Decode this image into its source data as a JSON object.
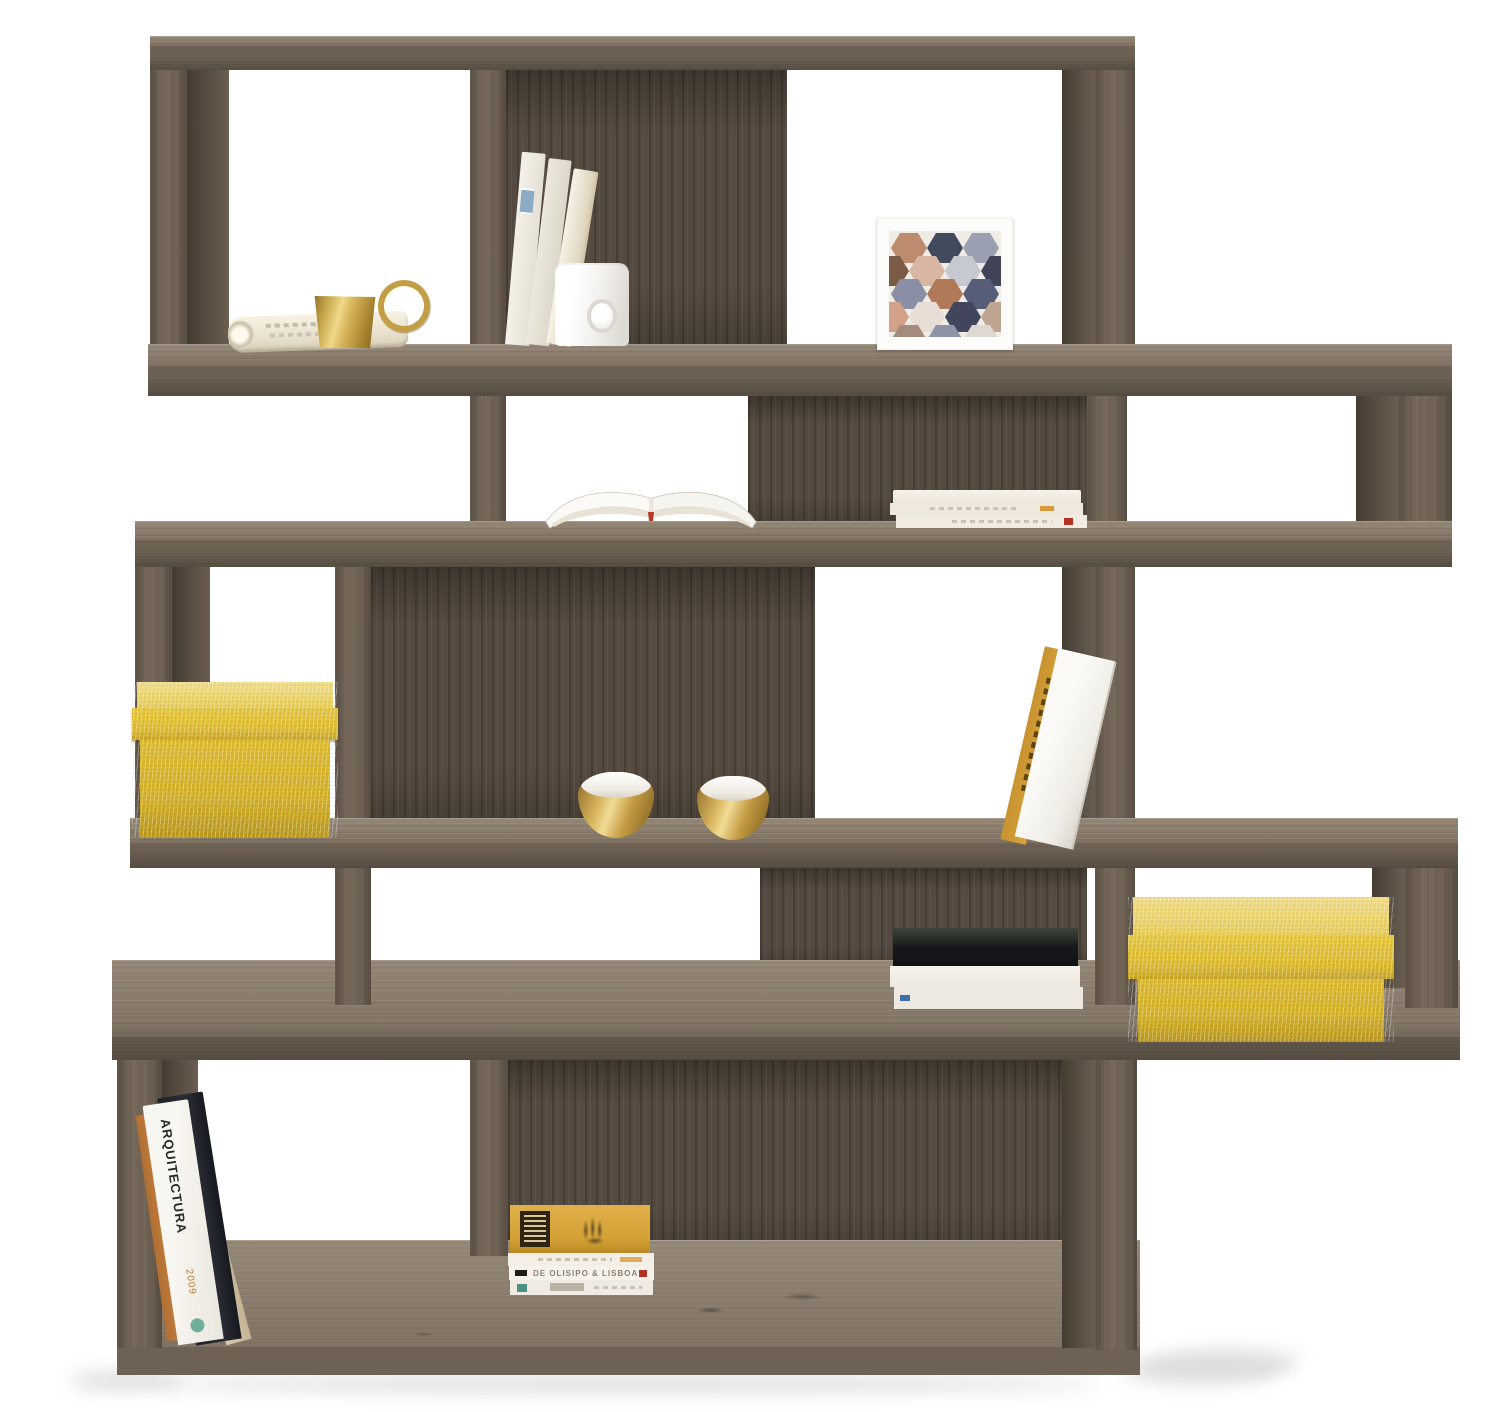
{
  "scene": {
    "type": "product-photograph",
    "subject": "Staggered zigzag wooden bookcase (5 open rows) in dark walnut finish, styled with books and decor objects on a white studio background",
    "background_color": "#ffffff"
  },
  "palette": {
    "wood_front": "#6e6254",
    "wood_top_surface": "#948776",
    "wood_back_panel": "#554a3f",
    "wood_edge_dark": "#4a4136",
    "accent_yellow_fabric": "#dcb92c",
    "brass_gold": "#c9a84c",
    "paper_cream": "#f3efe6",
    "mug_white": "#ffffff",
    "book_black": "#15181a",
    "amber_book": "#d9a93e",
    "magazine_orange": "#c8803f",
    "art_navy": "#3f4459",
    "art_copper": "#bd8b6d"
  },
  "furniture": {
    "label": "zigzag-bookcase",
    "rows": 5,
    "horizontal_boards": 6,
    "finish": "dark walnut woodgrain",
    "layout": "alternating tall and shallow rows with staggered dividers and partial back panels"
  },
  "items": {
    "row1": [
      "rolled magazine",
      "brass cup with ring handle",
      "three leaning paperbacks with blue sticker",
      "white ceramic mug with dimple",
      "white framed geometric hexagon art print"
    ],
    "row2": [
      "open magazine with fanned pages",
      "stack of three cream booklets"
    ],
    "row3": [
      "yellow fabric storage box with lid",
      "two brass candle bowls",
      "two leaning books (white and mustard)"
    ],
    "row4": [
      "stack with black book on two white books",
      "yellow fabric storage box with lid"
    ],
    "row5": [
      "four leaning magazines",
      "stack of four books with amber cover on top"
    ]
  },
  "book_spines": {
    "arquitectura_title": "ARQUITECTURA",
    "arquitectura_year": "2009",
    "olisipo_title": "DE OLISIPO & LISBOA"
  }
}
